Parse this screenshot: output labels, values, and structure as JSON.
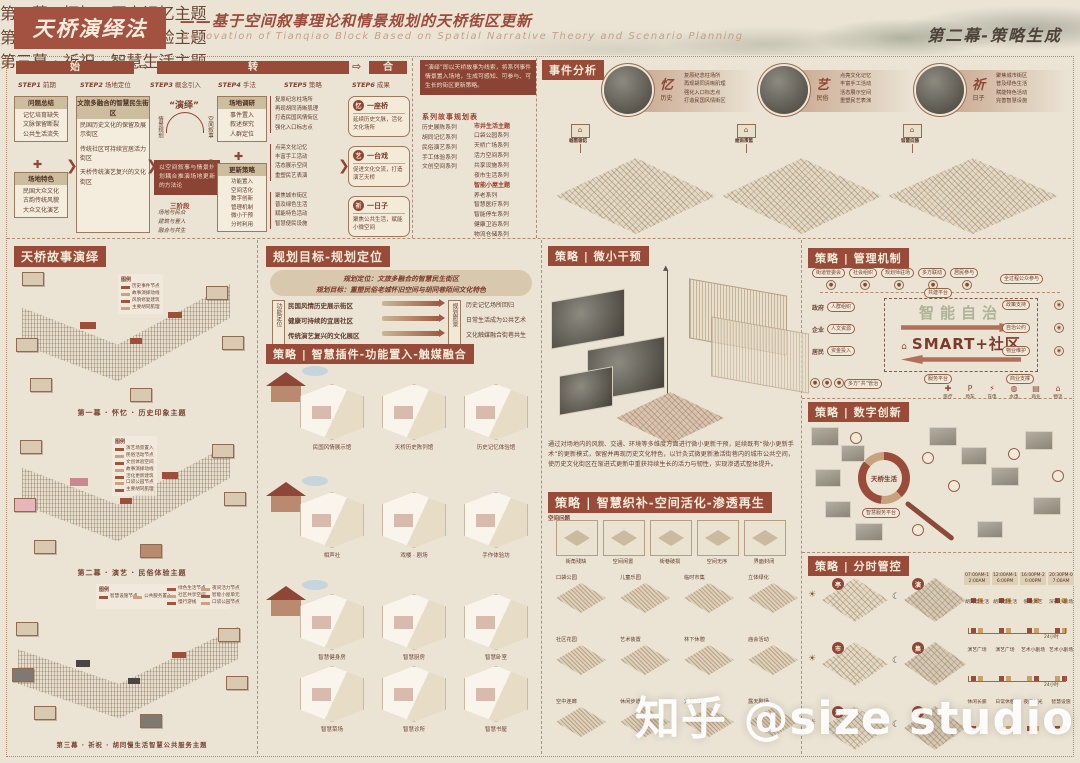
{
  "header": {
    "title": "天桥演绎法",
    "subtitle_cn": "——基于空间叙事理论和情景规划的天桥街区更新",
    "subtitle_en": "Renovation of Tianqiao Block Based on Spatial Narrative Theory and Scenario Planning",
    "act": "第二幕-策略生成"
  },
  "flow": {
    "phases": [
      "始",
      "转",
      "合"
    ],
    "steps": [
      {
        "step": "STEP1",
        "name": "前期"
      },
      {
        "step": "STEP2",
        "name": "场地定位"
      },
      {
        "step": "STEP3",
        "name": "概念引入"
      },
      {
        "step": "STEP4",
        "name": "手法"
      },
      {
        "step": "STEP5",
        "name": "策略"
      },
      {
        "step": "STEP6",
        "name": "成果"
      }
    ],
    "problems": {
      "title": "问题总结",
      "items": [
        "记忆培育缺失",
        "文脉保留断裂",
        "公共生活流失"
      ]
    },
    "site": {
      "title": "场地特色",
      "items": [
        "民国大众文化",
        "古韵传统风貌",
        "大众文化演艺"
      ]
    },
    "vision": {
      "title": "文旅多融合的智慧民生街区",
      "items": [
        "民国历史文化的保留及展示街区",
        "传统社区可持续宜居活力街区",
        "天桥传统演艺复兴的文化街区"
      ]
    },
    "deduction": {
      "label": "“演绎”",
      "left": "情景规划",
      "right": "空间叙事",
      "note": "以空间叙事与情景规划耦合推演场地更新的方法论",
      "stages_title": "三阶段",
      "stages": [
        "场地与民众",
        "建筑与置入",
        "融合与共生"
      ]
    },
    "research": {
      "title": "场地调研",
      "items": [
        "事件置入",
        "叙述探究",
        "人群定位"
      ]
    },
    "strategy": {
      "title": "更新策略",
      "items": [
        "功能置入",
        "空间活化",
        "数字创新",
        "管理机制",
        "微小干预",
        "分时利用"
      ]
    },
    "tactics": [
      {
        "items": [
          "复原纪念柱场所",
          "再现胡同清晰肌理",
          "打造民国风情街区",
          "强化入口标志点"
        ]
      },
      {
        "items": [
          "点亮文化记忆",
          "丰富手工活动",
          "活态展示空间",
          "重塑民艺表演"
        ]
      },
      {
        "items": [
          "聚焦城市街区",
          "普及绿色生活",
          "赋能特色活动",
          "智慧便民设施"
        ]
      }
    ],
    "scenes": [
      {
        "seal": "忆",
        "title": "一座桥",
        "desc": "延续历史文脉，活化文化场所"
      },
      {
        "seal": "艺",
        "title": "一台戏",
        "desc": "促进文化交流，打造演艺天桥"
      },
      {
        "seal": "祈",
        "title": "一日子",
        "desc": "聚焦公共生活，赋能小微空间"
      }
    ]
  },
  "series": {
    "note": "“演绎”即以天桥故事为线索，将系列事件情景置入场地，生成可感知、可参与、可生长的街区更新策略。",
    "title": "系列故事规划表",
    "left": [
      "历史展陈系列",
      "胡同记忆系列",
      "民俗演艺系列",
      "手工体验系列",
      "文创空间系列"
    ],
    "right_a_title": "市井生活主题",
    "right_a": [
      "口袋公园系列",
      "天桥广场系列",
      "活力空间系列",
      "共享设施系列",
      "夜市生活系列"
    ],
    "right_b_title": "智能小屋主题",
    "right_b": [
      "养老系列",
      "智慧医疗系列",
      "智能停车系列",
      "健康卫浴系列",
      "物流仓储系列"
    ]
  },
  "events": {
    "title": "事件分析",
    "groups": [
      {
        "seal": "忆",
        "sub": "历史",
        "lines": [
          "复原纪念柱场所",
          "再现胡同清晰肌理",
          "强化入口标志点",
          "打造民国风情街区"
        ],
        "signs": [
          "城市印记",
          "胡同记忆",
          "社区会馆"
        ]
      },
      {
        "seal": "艺",
        "sub": "民俗",
        "lines": [
          "点亮文化记忆",
          "丰富手工活动",
          "活态展示空间",
          "重塑民艺表演"
        ],
        "signs": [
          "文创市集",
          "相声茶馆",
          "街头演艺"
        ]
      },
      {
        "seal": "祈",
        "sub": "日子",
        "lines": [
          "聚焦城市街区",
          "普及绿色生活",
          "赋能特色活动",
          "完善智慧设施"
        ],
        "signs": [
          "智慧设施",
          "口袋公园",
          "邻里广场"
        ]
      }
    ]
  },
  "story": {
    "title": "天桥故事演绎",
    "legend_label": "图例",
    "acts": [
      {
        "caption": "第一幕 · 怀忆 · 历史印象主题",
        "legend": [
          "历史事件节点",
          "故事演绎动线",
          "风貌修复建筑",
          "主要胡同肌理"
        ]
      },
      {
        "caption": "第二幕 · 演艺 · 民俗体验主题",
        "legend": [
          "演艺场景置入",
          "民俗活动节点",
          "文创体验空间",
          "故事演绎动线",
          "活化更新建筑",
          "口袋公园节点",
          "主要胡同肌理"
        ]
      },
      {
        "caption": "第三幕 · 祈祝 · 胡同慢生活智慧公共服务主题",
        "legend": [
          "智慧设施节点",
          "公共服务置入",
          "绿色生活节点",
          "社区共享空间",
          "慢行游线",
          "夜间活力节点",
          "智能小屋单元",
          "口袋公园节点"
        ]
      }
    ]
  },
  "planning": {
    "title": "规划目标-规划定位",
    "position": "规划定位：文旅多融合的智慧民生街区",
    "goal": "规划目标：重塑民俗老城怀旧空间与胡同巷陌间文化特色",
    "left_label": "功能定位",
    "right_label": "规划愿景",
    "rows": [
      {
        "left": "民国风情历史展示街区",
        "right": "历史记忆场所回归"
      },
      {
        "left": "健康可持续的宜居社区",
        "right": "日常生活成为公共艺术"
      },
      {
        "left": "传统演艺复兴的文化展区",
        "right": "文化触媒融合街巷共生"
      }
    ]
  },
  "plugin": {
    "title": "策略 | 智慧插件-功能置入-触媒融合",
    "groups": [
      {
        "theme": "第一幕 · 怀忆 · 历史记忆主题",
        "items": [
          "民国风情展示馆",
          "天桥历史陈列馆",
          "历史记忆体验馆"
        ]
      },
      {
        "theme": "第二幕 · 演艺 · 民俗体验主题",
        "items": [
          "相声社",
          "戏楼 · 剧场",
          "手作体验坊"
        ]
      },
      {
        "theme": "第三幕 · 祈祝 · 智慧生活主题",
        "items": [
          "智慧健身房",
          "智慧厨房",
          "智慧卧室",
          "智慧菜场",
          "智慧诊所",
          "智慧书屋"
        ]
      }
    ]
  },
  "micro": {
    "title": "策略 | 微小干预",
    "para": "通过对场地内的风貌、交通、环境等多维度方面进行微小更新干预，延续既有“微小更新手术”的更新模式，保留并再现历史文化特色，以针灸式微更新激活街巷内的城市公共空间，使历史文化街区在渐进式更新中重获持续生长的活力与韧性，实现渗透式整体提升。"
  },
  "weave": {
    "title": "策略 | 智慧织补-空间活化-渗透再生",
    "problems_label": "空间问题",
    "problems": [
      "街角残缺",
      "空间闲置",
      "街巷破损",
      "空间无序",
      "界面封闭"
    ],
    "rows": [
      {
        "items": [
          "口袋公园",
          "儿童乐园",
          "临时市集",
          "立体绿化"
        ]
      },
      {
        "items": [
          "社区花园",
          "艺术装置",
          "林下休憩",
          "庙会活动"
        ]
      },
      {
        "items": [
          "空中连廊",
          "休闲步道",
          "文创市集",
          "露天剧场"
        ]
      }
    ]
  },
  "manage": {
    "title": "策略 | 管理机制",
    "top_pills": [
      "街道管委会",
      "社会组织",
      "规划师驻场",
      "多方联动",
      "居民参与"
    ],
    "top_right": "全过程公众参与",
    "above_pill": "共建平台",
    "below_pill": "服务平台",
    "center": "SMART+社区",
    "center_bg": "智能自治",
    "left_actors": [
      {
        "name": "政府",
        "pill": "人群组织"
      },
      {
        "name": "企业",
        "pill": "人文资源"
      },
      {
        "name": "居民",
        "pill": "资金投入"
      }
    ],
    "right_pills": [
      "政策支持",
      "自治公约",
      "物业维护"
    ],
    "bottom_left": "多方“共”管治",
    "bottom_right": "商业支撑",
    "facilities": [
      {
        "icon": "✚",
        "label": "医疗"
      },
      {
        "icon": "P",
        "label": "停车"
      },
      {
        "icon": "⚡",
        "label": "充电"
      },
      {
        "icon": "◍",
        "label": "水电"
      },
      {
        "icon": "▤",
        "label": "商业"
      },
      {
        "icon": "⌂",
        "label": "物流"
      }
    ]
  },
  "digital": {
    "title": "策略 | 数字创新",
    "center": "天桥生活",
    "sub": "智慧服务平台"
  },
  "time": {
    "title": "策略 | 分时管控",
    "headers": [
      "07:00AM-12:00AM",
      "12:00AM-16:00PM",
      "16:00PM-20:00PM",
      "20:30PM-07:00AM"
    ],
    "rows": [
      {
        "items": [
          "胡同慢生活",
          "胡同慢生活",
          "傍晚演艺",
          "深夜小剧场"
        ],
        "tag": "24小时"
      },
      {
        "items": [
          "演艺广场",
          "演艺广场",
          "艺术小剧场",
          "艺术小剧场"
        ],
        "tag": "24小时"
      },
      {
        "items": [
          "休闲长廊",
          "日常休憩",
          "夜间灯光",
          "智慧设施"
        ],
        "tag": ""
      }
    ],
    "day_seals": [
      "亭",
      "市",
      "游"
    ],
    "night_seals": [
      "演",
      "集",
      "灯"
    ]
  },
  "watermark": "知乎 @size studio"
}
